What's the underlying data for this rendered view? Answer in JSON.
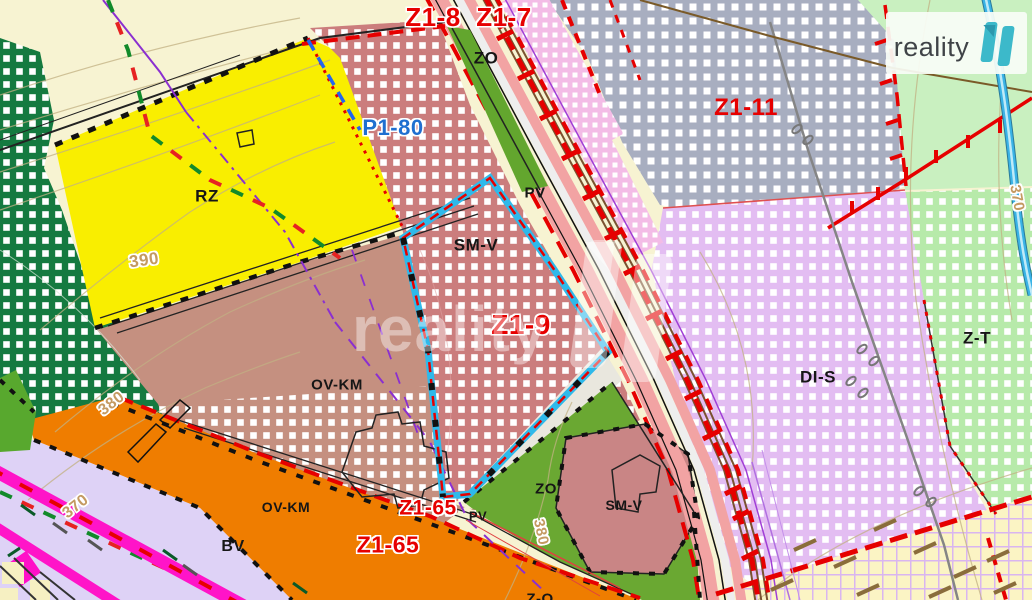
{
  "brand": {
    "name": "reality",
    "logo_number": "11"
  },
  "watermark": {
    "text": "reality",
    "logo_number": "11"
  },
  "map": {
    "colors": {
      "boundary_cyan": "#2fb9ea",
      "label_red": "#e60000",
      "label_blue": "#1f6fd0",
      "label_black": "#161616",
      "contour_tan": "#c49a62",
      "zone_yellow": "#f9ee00",
      "zone_orange": "#ef7d00",
      "zone_magenta": "#ff14c8",
      "zone_dark_green": "#157a40",
      "zone_dusty_red": "#cb7d7d",
      "zone_grey_blue": "#a8aec0",
      "zone_lavender": "#e3bdf2",
      "zone_light_green": "#b7eaaa",
      "zone_rose": "#c59080",
      "zone_cream": "#f7f3d2",
      "logo_teal": "#3cb9ca"
    },
    "labels": [
      {
        "id": "z1-8",
        "text": "Z1-8",
        "x": 433,
        "y": 17,
        "size": 26,
        "color": "red",
        "halo": true
      },
      {
        "id": "z1-7",
        "text": "Z1-7",
        "x": 504,
        "y": 17,
        "size": 26,
        "color": "red",
        "halo": true
      },
      {
        "id": "zo-top",
        "text": "ZO",
        "x": 486,
        "y": 58,
        "size": 17,
        "color": "black"
      },
      {
        "id": "p1-80",
        "text": "P1-80",
        "x": 393,
        "y": 128,
        "size": 22,
        "color": "blue",
        "halo": true
      },
      {
        "id": "pv-top",
        "text": "PV",
        "x": 535,
        "y": 193,
        "size": 15,
        "color": "black"
      },
      {
        "id": "sm-v-center",
        "text": "SM-V",
        "x": 476,
        "y": 245,
        "size": 17,
        "color": "black"
      },
      {
        "id": "z1-9",
        "text": "Z1-9",
        "x": 521,
        "y": 325,
        "size": 28,
        "color": "red",
        "halo": true
      },
      {
        "id": "z1-11",
        "text": "Z1-11",
        "x": 746,
        "y": 108,
        "size": 24,
        "color": "red"
      },
      {
        "id": "rz",
        "text": "RZ",
        "x": 207,
        "y": 196,
        "size": 17,
        "color": "black"
      },
      {
        "id": "ov-km-center",
        "text": "OV-KM",
        "x": 337,
        "y": 385,
        "size": 15,
        "color": "black"
      },
      {
        "id": "ov-km-bottom",
        "text": "OV-KM",
        "x": 286,
        "y": 507,
        "size": 14,
        "color": "black"
      },
      {
        "id": "bv",
        "text": "BV",
        "x": 233,
        "y": 547,
        "size": 16,
        "color": "black"
      },
      {
        "id": "di-s",
        "text": "DI-S",
        "x": 818,
        "y": 377,
        "size": 17,
        "color": "black"
      },
      {
        "id": "z-t",
        "text": "Z-T",
        "x": 977,
        "y": 338,
        "size": 17,
        "color": "black"
      },
      {
        "id": "zo-bottom",
        "text": "ZO",
        "x": 546,
        "y": 489,
        "size": 15,
        "color": "black"
      },
      {
        "id": "sm-v-bottom",
        "text": "SM-V",
        "x": 624,
        "y": 505,
        "size": 14,
        "color": "black"
      },
      {
        "id": "z1-65-upper",
        "text": "Z1-65",
        "x": 428,
        "y": 508,
        "size": 21,
        "color": "red",
        "halo": true
      },
      {
        "id": "z1-65-lower",
        "text": "Z1-65",
        "x": 388,
        "y": 545,
        "size": 23,
        "color": "red",
        "halo": true
      },
      {
        "id": "pv-bottom",
        "text": "PV",
        "x": 478,
        "y": 516,
        "size": 13,
        "color": "black"
      },
      {
        "id": "z-o-bottom",
        "text": "Z-O",
        "x": 540,
        "y": 599,
        "size": 15,
        "color": "black"
      },
      {
        "id": "contour-390",
        "text": "390",
        "x": 144,
        "y": 260,
        "size": 17,
        "color": "tan",
        "halo": true,
        "rot": -8
      },
      {
        "id": "contour-380-left",
        "text": "380",
        "x": 112,
        "y": 404,
        "size": 16,
        "color": "tan",
        "halo": true,
        "rot": -38
      },
      {
        "id": "contour-370-left",
        "text": "370",
        "x": 76,
        "y": 507,
        "size": 16,
        "color": "tan",
        "halo": true,
        "rot": -38
      },
      {
        "id": "contour-380-center",
        "text": "380",
        "x": 541,
        "y": 532,
        "size": 15,
        "color": "tan",
        "halo": true,
        "rot": 78
      },
      {
        "id": "contour-370-right",
        "text": "370",
        "x": 1017,
        "y": 198,
        "size": 15,
        "color": "tan",
        "halo": true,
        "rot": 80
      }
    ]
  }
}
